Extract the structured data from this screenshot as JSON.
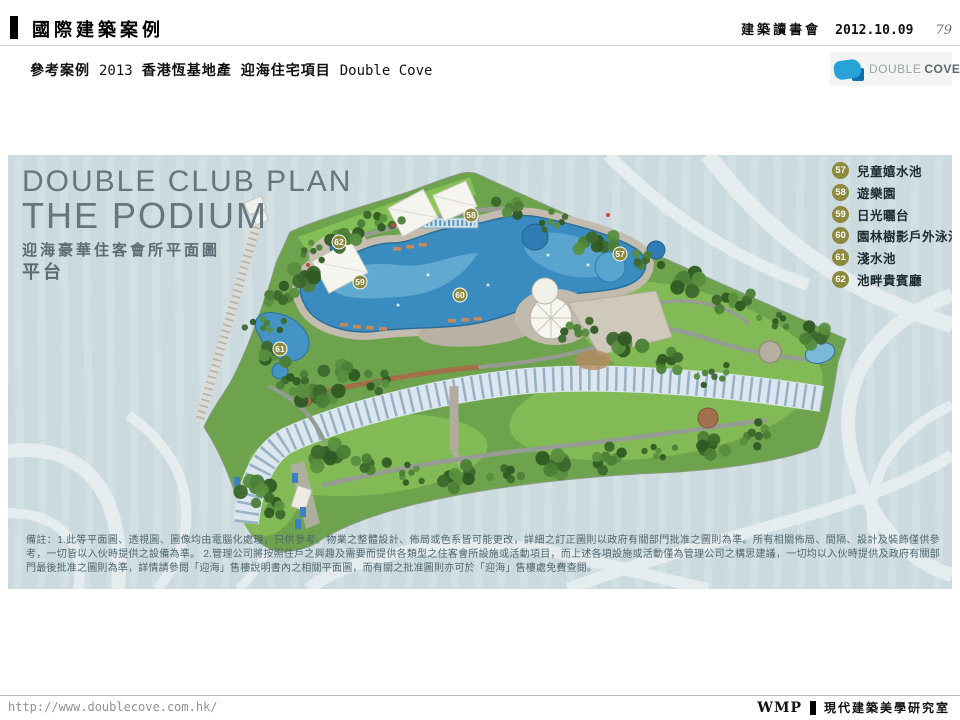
{
  "header": {
    "title": "國際建築案例",
    "event": "建築讀書會",
    "date": "2012.10.09",
    "page": "79"
  },
  "subheader": {
    "prefix": "參考案例",
    "year": "2013",
    "developer": "香港恆基地產",
    "project": "迎海住宅項目",
    "project_en": "Double Cove"
  },
  "logo": {
    "name_1": "DOUBLE",
    "name_2": "COVE"
  },
  "plan": {
    "title_en_1": "DOUBLE CLUB PLAN",
    "title_en_2": "THE PODIUM",
    "title_zh": "迎海豪華住客會所平面圖",
    "subtitle_zh": "平台",
    "legend": [
      {
        "num": "57",
        "label": "兒童嬉水池"
      },
      {
        "num": "58",
        "label": "遊樂園"
      },
      {
        "num": "59",
        "label": "日光曬台"
      },
      {
        "num": "60",
        "label": "園林樹影戶外泳池"
      },
      {
        "num": "61",
        "label": "淺水池"
      },
      {
        "num": "62",
        "label": "池畔貴賓廳"
      }
    ],
    "markers": [
      "57",
      "58",
      "59",
      "60",
      "61",
      "62"
    ],
    "disclaimer": "備註：1.此等平面圖、透視圖、圖像均由電腦化處理，只供參考。物業之整體設計、佈局或色系皆可能更改，詳細之訂正圖則以政府有關部門批准之圖則為準。所有相關佈局、間隔、設計及裝飾僅供參考，一切皆以入伙時提供之設備為準。 2.管理公司將按照住戶之興趣及需要而提供各類型之住客會所設施或活動項目，而上述各項設施或活動僅為管理公司之構思建議，一切均以入伙時提供及政府有關部門最後批准之圖則為準，詳情請參閱「迎海」售樓說明書內之相關平面圖，而有關之批准圖則亦可於「迎海」售樓處免費查閱。"
  },
  "footer": {
    "url": "http://www.doublecove.com.hk/",
    "brand": "WMP",
    "studio": "現代建築美學研究室"
  },
  "colors": {
    "panel_bg": "#cadade",
    "legend_badge": "#8d893f",
    "pool_blue": "#3a8cc0",
    "logo_blue": "#27a3d8"
  }
}
